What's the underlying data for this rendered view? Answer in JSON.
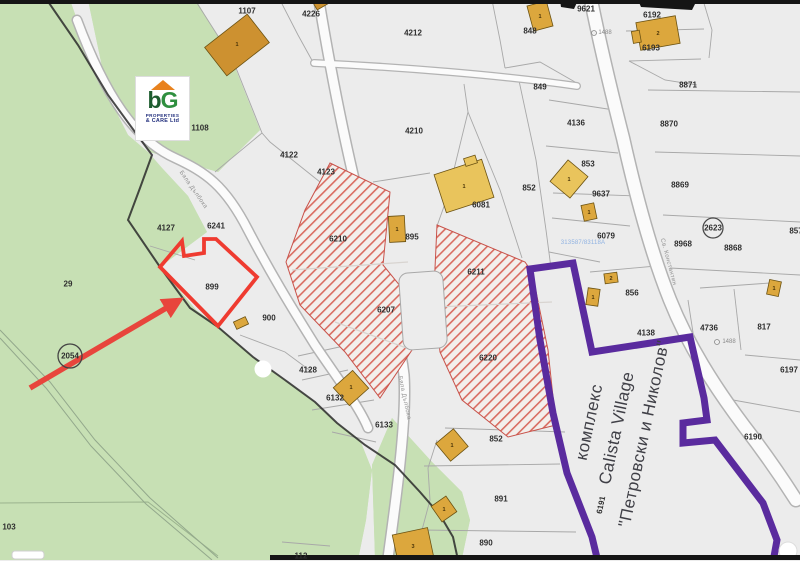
{
  "map": {
    "watermark_logo": {
      "letter_b": "b",
      "letter_g": "G",
      "line1": "PROPERTIES",
      "line2": "& CARE Ltd"
    },
    "complex_label": {
      "line1": "комплекс",
      "line2": "Calista Village",
      "line3": "\"Петровски и Николов\""
    },
    "reference_number": {
      "t": "313587/83118А",
      "x": 583,
      "y": 243
    },
    "parcel_labels": [
      {
        "t": "1107",
        "x": 247,
        "y": 11
      },
      {
        "t": "4226",
        "x": 311,
        "y": 14
      },
      {
        "t": "4212",
        "x": 413,
        "y": 33
      },
      {
        "t": "9621",
        "x": 586,
        "y": 9
      },
      {
        "t": "6192",
        "x": 652,
        "y": 15
      },
      {
        "t": "848",
        "x": 530,
        "y": 31
      },
      {
        "t": "6193",
        "x": 651,
        "y": 48
      },
      {
        "t": "849",
        "x": 540,
        "y": 87
      },
      {
        "t": "8871",
        "x": 688,
        "y": 85
      },
      {
        "t": "1108",
        "x": 200,
        "y": 128
      },
      {
        "t": "4122",
        "x": 289,
        "y": 155
      },
      {
        "t": "4123",
        "x": 326,
        "y": 172
      },
      {
        "t": "4210",
        "x": 414,
        "y": 131
      },
      {
        "t": "852",
        "x": 529,
        "y": 188
      },
      {
        "t": "4136",
        "x": 576,
        "y": 123
      },
      {
        "t": "853",
        "x": 588,
        "y": 164
      },
      {
        "t": "9637",
        "x": 601,
        "y": 194
      },
      {
        "t": "6079",
        "x": 606,
        "y": 236
      },
      {
        "t": "8870",
        "x": 669,
        "y": 124
      },
      {
        "t": "8869",
        "x": 680,
        "y": 185
      },
      {
        "t": "8968",
        "x": 683,
        "y": 244
      },
      {
        "t": "8868",
        "x": 733,
        "y": 248
      },
      {
        "t": "2623",
        "x": 713,
        "y": 228
      },
      {
        "t": "857",
        "x": 796,
        "y": 231
      },
      {
        "t": "4127",
        "x": 166,
        "y": 228
      },
      {
        "t": "6241",
        "x": 216,
        "y": 226
      },
      {
        "t": "29",
        "x": 68,
        "y": 284
      },
      {
        "t": "2054",
        "x": 70,
        "y": 356
      },
      {
        "t": "899",
        "x": 212,
        "y": 287
      },
      {
        "t": "900",
        "x": 269,
        "y": 318
      },
      {
        "t": "895",
        "x": 412,
        "y": 237
      },
      {
        "t": "6081",
        "x": 481,
        "y": 205
      },
      {
        "t": "6210",
        "x": 338,
        "y": 239
      },
      {
        "t": "6211",
        "x": 476,
        "y": 272
      },
      {
        "t": "6207",
        "x": 386,
        "y": 310
      },
      {
        "t": "6220",
        "x": 488,
        "y": 358
      },
      {
        "t": "4128",
        "x": 308,
        "y": 370
      },
      {
        "t": "6132",
        "x": 335,
        "y": 398
      },
      {
        "t": "6133",
        "x": 384,
        "y": 425
      },
      {
        "t": "112",
        "x": 301,
        "y": 556
      },
      {
        "t": "103",
        "x": 9,
        "y": 527
      },
      {
        "t": "856",
        "x": 632,
        "y": 293
      },
      {
        "t": "4138",
        "x": 646,
        "y": 333
      },
      {
        "t": "4736",
        "x": 709,
        "y": 328
      },
      {
        "t": "817",
        "x": 764,
        "y": 327
      },
      {
        "t": "6197",
        "x": 789,
        "y": 370
      },
      {
        "t": "6190",
        "x": 753,
        "y": 437
      },
      {
        "t": "852",
        "x": 496,
        "y": 439
      },
      {
        "t": "891",
        "x": 501,
        "y": 499
      },
      {
        "t": "890",
        "x": 486,
        "y": 543
      },
      {
        "t": "6191",
        "x": 601,
        "y": 505,
        "rot": -78
      },
      {
        "t": "1488",
        "x": 605,
        "y": 33,
        "cls": "sm"
      },
      {
        "t": "1488",
        "x": 729,
        "y": 342,
        "cls": "sm"
      }
    ],
    "building_labels": [
      {
        "t": "1",
        "x": 237,
        "y": 45
      },
      {
        "t": "1",
        "x": 540,
        "y": 17
      },
      {
        "t": "2",
        "x": 658,
        "y": 34
      },
      {
        "t": "1",
        "x": 464,
        "y": 187
      },
      {
        "t": "1",
        "x": 397,
        "y": 230
      },
      {
        "t": "1",
        "x": 569,
        "y": 180
      },
      {
        "t": "1",
        "x": 589,
        "y": 213
      },
      {
        "t": "1",
        "x": 351,
        "y": 388
      },
      {
        "t": "1",
        "x": 452,
        "y": 446
      },
      {
        "t": "1",
        "x": 444,
        "y": 510
      },
      {
        "t": "3",
        "x": 413,
        "y": 547
      },
      {
        "t": "1",
        "x": 593,
        "y": 298
      },
      {
        "t": "2",
        "x": 611,
        "y": 279
      },
      {
        "t": "1",
        "x": 774,
        "y": 289
      }
    ],
    "road_labels": [
      {
        "t": "Бяла Дълбока",
        "x": 193,
        "y": 190,
        "rot": 55
      },
      {
        "t": "Бяла Дълбока",
        "x": 404,
        "y": 398,
        "rot": 78
      },
      {
        "t": "Св. Константин",
        "x": 668,
        "y": 262,
        "rot": 75
      }
    ],
    "colors": {
      "highlight_outline": "#ef3b30",
      "arrow": "#e8453c",
      "complex_outline": "#5a2b9e",
      "hatch_stripe": "#d24b3e",
      "green_area": "#c7e0b4",
      "building_fill": "#dca73d"
    }
  }
}
